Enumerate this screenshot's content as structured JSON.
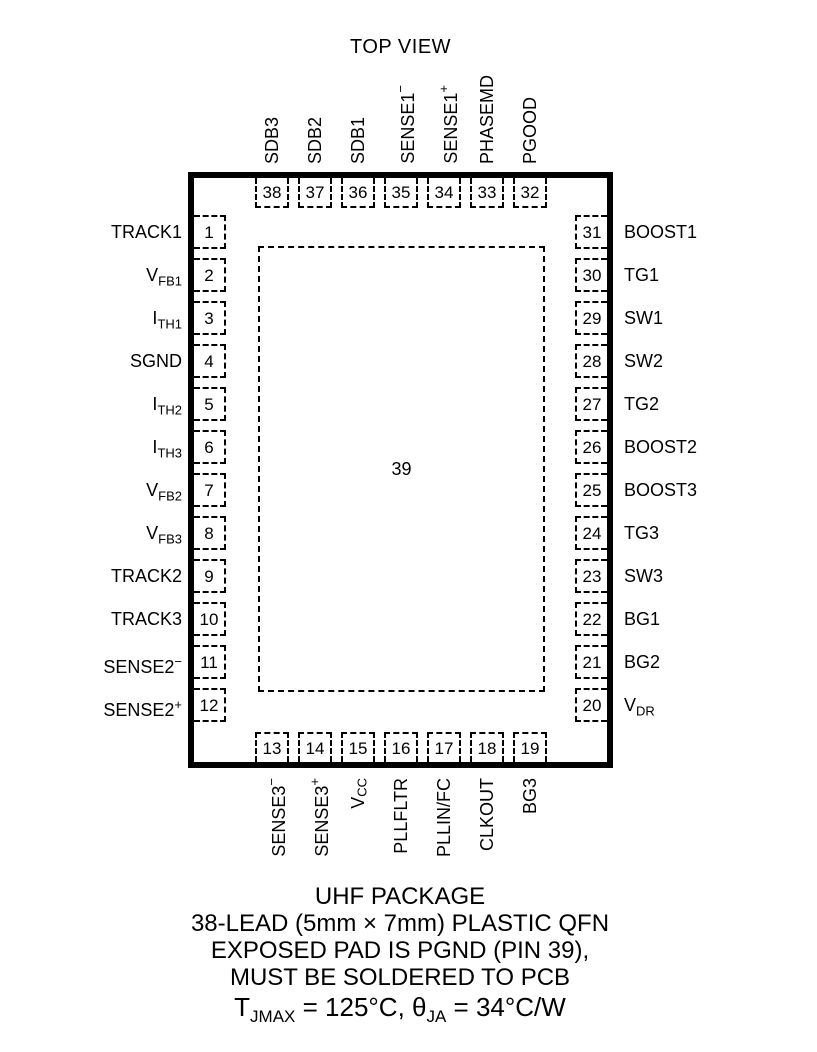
{
  "diagram": {
    "title": "TOP VIEW",
    "pad": {
      "number": "39"
    },
    "pins": {
      "top": [
        {
          "num": "38",
          "label": {
            "text": "SDB3"
          }
        },
        {
          "num": "37",
          "label": {
            "text": "SDB2"
          }
        },
        {
          "num": "36",
          "label": {
            "text": "SDB1"
          }
        },
        {
          "num": "35",
          "label": {
            "text": "SENSE1",
            "sup": "−"
          }
        },
        {
          "num": "34",
          "label": {
            "text": "SENSE1",
            "sup": "+"
          }
        },
        {
          "num": "33",
          "label": {
            "text": "PHASEMD"
          }
        },
        {
          "num": "32",
          "label": {
            "text": "PGOOD"
          }
        }
      ],
      "left": [
        {
          "num": "1",
          "label": {
            "text": "TRACK1"
          }
        },
        {
          "num": "2",
          "label": {
            "text": "V",
            "sub": "FB1"
          }
        },
        {
          "num": "3",
          "label": {
            "text": "I",
            "sub": "TH1"
          }
        },
        {
          "num": "4",
          "label": {
            "text": "SGND"
          }
        },
        {
          "num": "5",
          "label": {
            "text": "I",
            "sub": "TH2"
          }
        },
        {
          "num": "6",
          "label": {
            "text": "I",
            "sub": "TH3"
          }
        },
        {
          "num": "7",
          "label": {
            "text": "V",
            "sub": "FB2"
          }
        },
        {
          "num": "8",
          "label": {
            "text": "V",
            "sub": "FB3"
          }
        },
        {
          "num": "9",
          "label": {
            "text": "TRACK2"
          }
        },
        {
          "num": "10",
          "label": {
            "text": "TRACK3"
          }
        },
        {
          "num": "11",
          "label": {
            "text": "SENSE2",
            "sup": "−"
          }
        },
        {
          "num": "12",
          "label": {
            "text": "SENSE2",
            "sup": "+"
          }
        }
      ],
      "right": [
        {
          "num": "31",
          "label": {
            "text": "BOOST1"
          }
        },
        {
          "num": "30",
          "label": {
            "text": "TG1"
          }
        },
        {
          "num": "29",
          "label": {
            "text": "SW1"
          }
        },
        {
          "num": "28",
          "label": {
            "text": "SW2"
          }
        },
        {
          "num": "27",
          "label": {
            "text": "TG2"
          }
        },
        {
          "num": "26",
          "label": {
            "text": "BOOST2"
          }
        },
        {
          "num": "25",
          "label": {
            "text": "BOOST3"
          }
        },
        {
          "num": "24",
          "label": {
            "text": "TG3"
          }
        },
        {
          "num": "23",
          "label": {
            "text": "SW3"
          }
        },
        {
          "num": "22",
          "label": {
            "text": "BG1"
          }
        },
        {
          "num": "21",
          "label": {
            "text": "BG2"
          }
        },
        {
          "num": "20",
          "label": {
            "text": "V",
            "sub": "DR"
          }
        }
      ],
      "bottom": [
        {
          "num": "13",
          "label": {
            "text": "SENSE3",
            "sup": "−"
          }
        },
        {
          "num": "14",
          "label": {
            "text": "SENSE3",
            "sup": "+"
          }
        },
        {
          "num": "15",
          "label": {
            "text": "V",
            "sub": "CC"
          }
        },
        {
          "num": "16",
          "label": {
            "text": "PLLFLTR"
          }
        },
        {
          "num": "17",
          "label": {
            "text": "PLLIN/FC"
          }
        },
        {
          "num": "18",
          "label": {
            "text": "CLKOUT"
          }
        },
        {
          "num": "19",
          "label": {
            "text": "BG3"
          }
        }
      ]
    },
    "notes": {
      "line1": "UHF PACKAGE",
      "line2": "38-LEAD (5mm × 7mm) PLASTIC QFN",
      "line3": "EXPOSED PAD IS PGND (PIN 39),",
      "line4": "MUST BE SOLDERED TO PCB",
      "thermal": {
        "t_main": "T",
        "t_sub": "JMAX",
        "mid": " = 125°C, θ",
        "theta_sub": "JA",
        "tail": " = 34°C/W"
      }
    },
    "colors": {
      "line": "#000000",
      "background": "#ffffff"
    }
  }
}
